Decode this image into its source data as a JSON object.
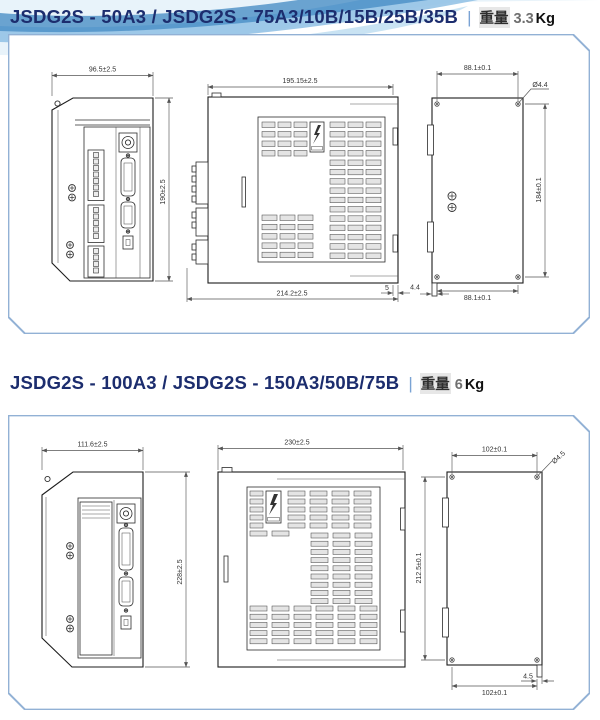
{
  "accent": {
    "title_color": "#1c2d6e",
    "panel_border": "#92b1d5",
    "wave": [
      "#e8f3fa",
      "#8fc0e4",
      "#4a8ec6",
      "#b7d9ef"
    ]
  },
  "sections": [
    {
      "title": "JSDG2S - 50A3 / JSDG2S - 75A3/10B/15B/25B/35B",
      "separator": "|",
      "weight_label": "重量",
      "weight_value": "3.3",
      "weight_unit": "Kg",
      "dims": {
        "front_width": "96.5±2.5",
        "front_height": "190±2.5",
        "side_top_width": "195.15±2.5",
        "side_bottom_width": "214.2±2.5",
        "side_flange_offset": "5",
        "back_top_pitch": "88.1±0.1",
        "back_bottom_pitch": "88.1±0.1",
        "back_height_pitch": "184±0.1",
        "back_hole_dia": "Ø4.4",
        "back_tab": "4.4"
      }
    },
    {
      "title": "JSDG2S - 100A3 / JSDG2S - 150A3/50B/75B",
      "separator": "|",
      "weight_label": "重量",
      "weight_value": "6",
      "weight_unit": "Kg",
      "dims": {
        "front_width": "111.6±2.5",
        "front_height": "228±2.5",
        "side_top_width": "230±2.5",
        "back_top_pitch": "102±0.1",
        "back_bottom_pitch": "102±0.1",
        "back_height_pitch": "212.5±0.1",
        "back_hole_dia": "Ø4.5",
        "back_tab": "4.5"
      }
    }
  ]
}
